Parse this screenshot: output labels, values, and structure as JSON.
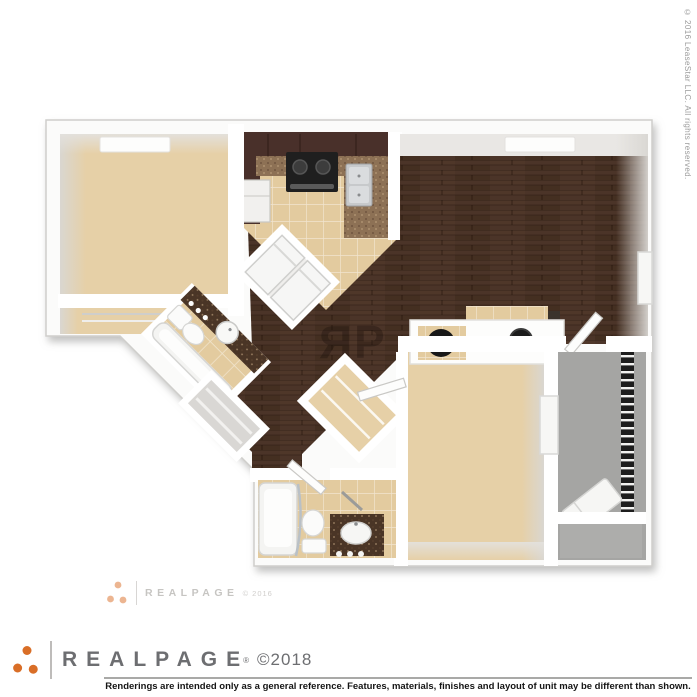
{
  "branding": {
    "side_copyright": "© 2016 LeaseStar LLC. All rights reserved.",
    "watermark_wordmark": "REALPAGE",
    "watermark_year": "© 2016",
    "footer_wordmark": "REALPAGE",
    "footer_registered_mark": "®",
    "footer_year": "©2018",
    "disclaimer": "Renderings are intended only as a general reference. Features, materials, finishes and layout of unit may be different than shown.",
    "floor_monogram_left": "R",
    "floor_monogram_right": "P"
  },
  "colors": {
    "accent": "#d96e27",
    "brand-gray": "#6d6e71",
    "carpet": "#e6d0a7",
    "wood": "#4b3428",
    "tile": "#e3cb9f",
    "balcony": "#a5a5a3",
    "granite": "#8d7155",
    "granite-dark": "#4a3526",
    "cabinet": "#49302a"
  }
}
